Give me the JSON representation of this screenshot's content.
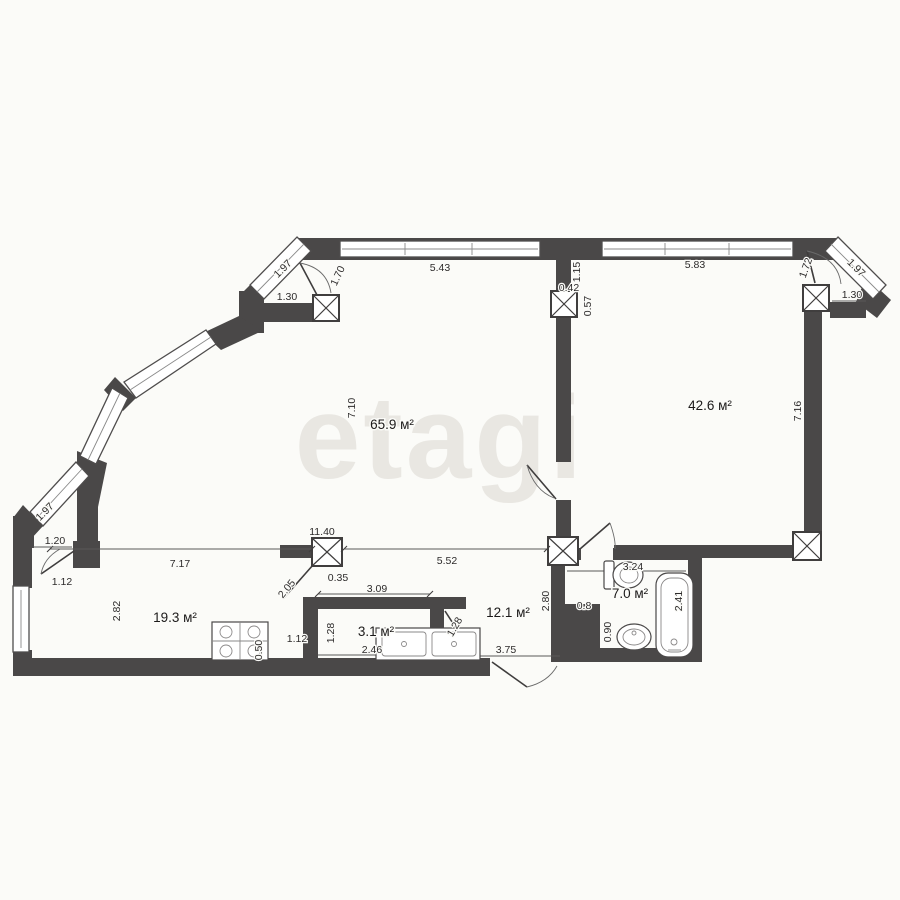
{
  "watermark": "etagi",
  "rooms": {
    "living": "65.9 м²",
    "bedroom": "42.6 м²",
    "kitchen": "19.3 м²",
    "storage": "3.1 м²",
    "hallway": "12.1 м²",
    "bathroom": "7.0 м²"
  },
  "dims": {
    "top_diag_left": "1.97",
    "balcony_door_left": "1.70",
    "balcony_width_left": "1.30",
    "window_top_left": "5.43",
    "wall_mid_top": "1.15",
    "col_offset_a": "0.42",
    "col_offset_b": "0.57",
    "window_top_right": "5.83",
    "balcony_door_right": "1.72",
    "top_diag_right": "1.97",
    "balcony_width_right": "1.30",
    "living_height": "7.10",
    "bedroom_height": "7.16",
    "mid_diag_left": "1.97",
    "niche_width": "1.20",
    "kitchen_door": "1.12",
    "total_width": "11.40",
    "col_offset_c": "0.35",
    "living_opening": "2.05",
    "kitchen_opening": "7.17",
    "hall_opening": "5.52",
    "bath_width": "3.24",
    "hall_height": "2.80",
    "shaft_width": "0.8",
    "shaft_height": "0.90",
    "bath_length": "2.41",
    "kitchen_height": "2.82",
    "storage_width_top": "3.09",
    "storage_height": "1.28",
    "storage_width_bottom": "2.46",
    "kitchen_wall": "1.12",
    "wall_stub": "0.50",
    "storage_door": "1.28",
    "entry_door": "3.75"
  }
}
